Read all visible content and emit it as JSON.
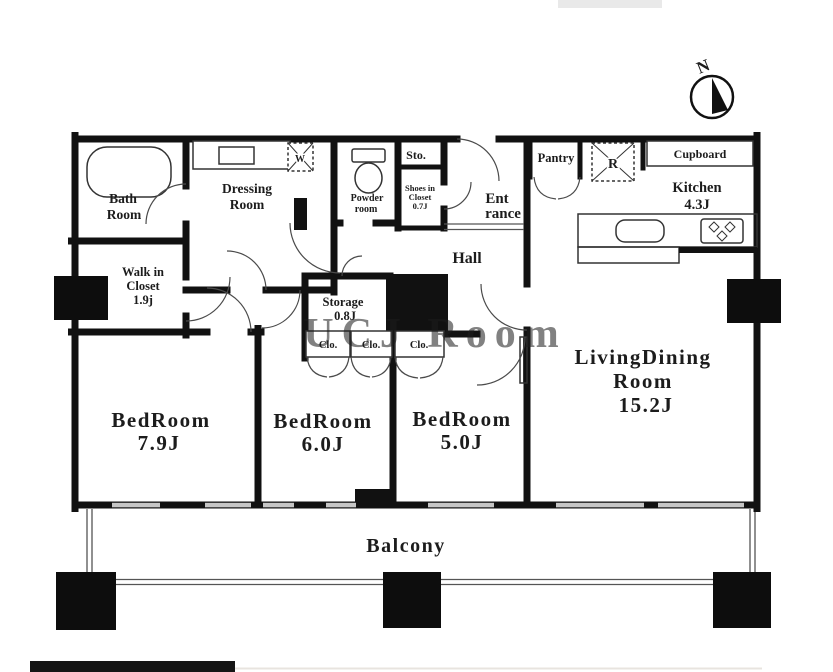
{
  "plan": {
    "north_label": "N",
    "watermark": "UCJ Room",
    "rooms": {
      "bath": {
        "line1": "Bath",
        "line2": "Room"
      },
      "dressing": {
        "line1": "Dressing",
        "line2": "Room"
      },
      "walk_in_closet": {
        "line1": "Walk in",
        "line2": "Closet",
        "line3": "1.9j"
      },
      "powder": {
        "line1": "Powder",
        "line2": "room"
      },
      "sto": {
        "label": "Sto."
      },
      "shoes_closet": {
        "line1": "Shoes in",
        "line2": "Closet",
        "line3": "0.7J"
      },
      "entrance": {
        "line1": "Ent",
        "line2": "rance"
      },
      "hall": {
        "label": "Hall"
      },
      "pantry": {
        "label": "Pantry"
      },
      "refrigerator": {
        "label": "R"
      },
      "washer": {
        "label": "W"
      },
      "cupboard": {
        "label": "Cupboard"
      },
      "kitchen": {
        "line1": "Kitchen",
        "line2": "4.3J"
      },
      "storage": {
        "line1": "Storage",
        "line2": "0.8J"
      },
      "closet1": {
        "label": "Clo."
      },
      "closet2": {
        "label": "Clo."
      },
      "closet3": {
        "label": "Clo."
      },
      "bedroom_79": {
        "line1": "BedRoom",
        "line2": "7.9J"
      },
      "bedroom_60": {
        "line1": "BedRoom",
        "line2": "6.0J"
      },
      "bedroom_50": {
        "line1": "BedRoom",
        "line2": "5.0J"
      },
      "living_dining": {
        "line1": "LivingDining",
        "line2": "Room",
        "line3": "15.2J"
      },
      "balcony": {
        "label": "Balcony"
      }
    },
    "colors": {
      "wall": "#111111",
      "window": "#c6c6c6",
      "watermark": "#ccc9c3"
    }
  }
}
